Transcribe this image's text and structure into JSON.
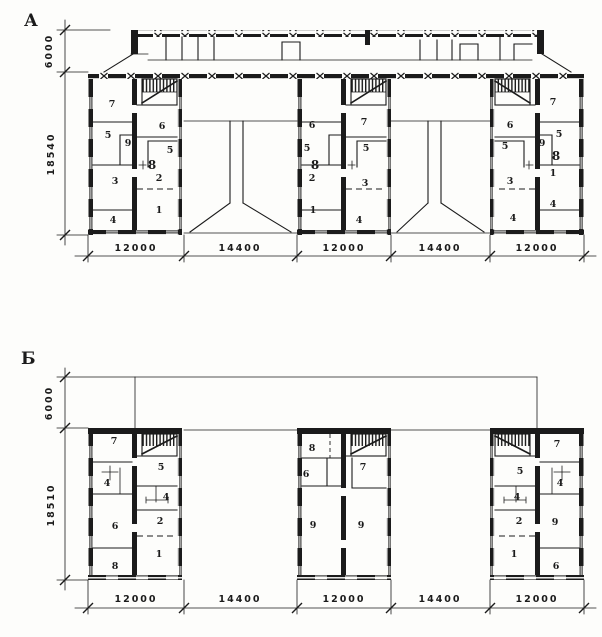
{
  "drawing": {
    "kind": "two floor-plan schemes of sectional apartment blocks",
    "paper_color": "#fdfdfb",
    "ink_color": "#1b1b1b",
    "plans": [
      {
        "id": "planA",
        "letter": "А",
        "vertical_dims": [
          {
            "t": "6000",
            "x": 52,
            "y": 51,
            "rot": -90
          },
          {
            "t": "18540",
            "x": 54,
            "y": 154,
            "rot": -90
          }
        ],
        "horizontal_dims": [
          {
            "t": "12000",
            "x": 136,
            "y": 251
          },
          {
            "t": "14400",
            "x": 240,
            "y": 251
          },
          {
            "t": "12000",
            "x": 344,
            "y": 251
          },
          {
            "t": "14400",
            "x": 440,
            "y": 251
          },
          {
            "t": "12000",
            "x": 537,
            "y": 251
          }
        ],
        "rooms": [
          {
            "t": "7",
            "x": 112,
            "y": 107
          },
          {
            "t": "5",
            "x": 108,
            "y": 138
          },
          {
            "t": "9",
            "x": 128,
            "y": 146
          },
          {
            "t": "3",
            "x": 115,
            "y": 184
          },
          {
            "t": "4",
            "x": 113,
            "y": 223
          },
          {
            "t": "6",
            "x": 162,
            "y": 129
          },
          {
            "t": "5",
            "x": 170,
            "y": 153
          },
          {
            "t": "8",
            "x": 152,
            "y": 169,
            "cls": "b"
          },
          {
            "t": "2",
            "x": 159,
            "y": 181
          },
          {
            "t": "1",
            "x": 159,
            "y": 213
          },
          {
            "t": "6",
            "x": 312,
            "y": 128
          },
          {
            "t": "5",
            "x": 307,
            "y": 151
          },
          {
            "t": "8",
            "x": 315,
            "y": 169,
            "cls": "b"
          },
          {
            "t": "2",
            "x": 312,
            "y": 181
          },
          {
            "t": "1",
            "x": 313,
            "y": 213
          },
          {
            "t": "7",
            "x": 364,
            "y": 125
          },
          {
            "t": "5",
            "x": 366,
            "y": 151
          },
          {
            "t": "3",
            "x": 365,
            "y": 186
          },
          {
            "t": "4",
            "x": 359,
            "y": 223
          },
          {
            "t": "6",
            "x": 510,
            "y": 128
          },
          {
            "t": "5",
            "x": 505,
            "y": 149
          },
          {
            "t": "3",
            "x": 510,
            "y": 184
          },
          {
            "t": "4",
            "x": 513,
            "y": 221
          },
          {
            "t": "7",
            "x": 553,
            "y": 105
          },
          {
            "t": "5",
            "x": 559,
            "y": 137
          },
          {
            "t": "9",
            "x": 542,
            "y": 146
          },
          {
            "t": "8",
            "x": 556,
            "y": 160,
            "cls": "b"
          },
          {
            "t": "1",
            "x": 553,
            "y": 176
          },
          {
            "t": "4",
            "x": 553,
            "y": 207
          }
        ]
      },
      {
        "id": "planB",
        "letter": "Б",
        "vertical_dims": [
          {
            "t": "6000",
            "x": 52,
            "y": 403,
            "rot": -90
          },
          {
            "t": "18510",
            "x": 54,
            "y": 505,
            "rot": -90
          }
        ],
        "horizontal_dims": [
          {
            "t": "12000",
            "x": 136,
            "y": 602
          },
          {
            "t": "14400",
            "x": 240,
            "y": 602
          },
          {
            "t": "12000",
            "x": 344,
            "y": 602
          },
          {
            "t": "14400",
            "x": 440,
            "y": 602
          },
          {
            "t": "12000",
            "x": 537,
            "y": 602
          }
        ],
        "rooms": [
          {
            "t": "7",
            "x": 114,
            "y": 444
          },
          {
            "t": "4",
            "x": 107,
            "y": 486
          },
          {
            "t": "6",
            "x": 115,
            "y": 529
          },
          {
            "t": "8",
            "x": 115,
            "y": 569
          },
          {
            "t": "5",
            "x": 161,
            "y": 470
          },
          {
            "t": "4",
            "x": 166,
            "y": 500
          },
          {
            "t": "2",
            "x": 160,
            "y": 524
          },
          {
            "t": "1",
            "x": 159,
            "y": 557
          },
          {
            "t": "8",
            "x": 312,
            "y": 451
          },
          {
            "t": "6",
            "x": 306,
            "y": 477
          },
          {
            "t": "9",
            "x": 313,
            "y": 528
          },
          {
            "t": "7",
            "x": 363,
            "y": 470
          },
          {
            "t": "9",
            "x": 361,
            "y": 528
          },
          {
            "t": "5",
            "x": 520,
            "y": 474
          },
          {
            "t": "4",
            "x": 517,
            "y": 500
          },
          {
            "t": "2",
            "x": 519,
            "y": 524
          },
          {
            "t": "1",
            "x": 514,
            "y": 557
          },
          {
            "t": "7",
            "x": 557,
            "y": 447
          },
          {
            "t": "4",
            "x": 560,
            "y": 486
          },
          {
            "t": "9",
            "x": 555,
            "y": 525
          },
          {
            "t": "6",
            "x": 556,
            "y": 569
          }
        ]
      }
    ]
  }
}
